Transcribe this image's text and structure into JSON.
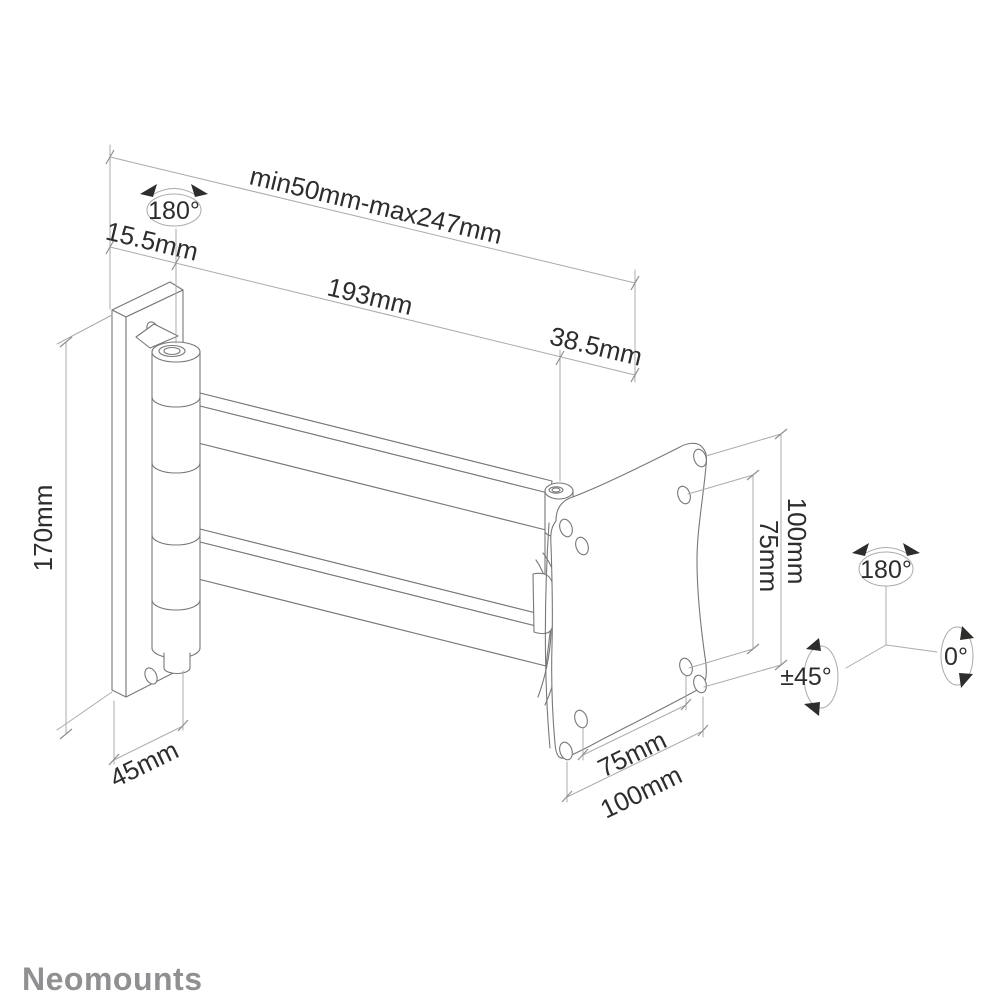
{
  "brand": {
    "logo_text": "Neomounts"
  },
  "dimensions": {
    "extension_range": "min50mm-max247mm",
    "wall_plate_offset": "15.5mm",
    "arm_length": "193mm",
    "head_offset": "38.5mm",
    "wall_plate_height": "170mm",
    "wall_plate_width": "45mm",
    "vesa_height_outer": "100mm",
    "vesa_height_inner": "75mm",
    "vesa_width_inner": "75mm",
    "vesa_width_outer": "100mm"
  },
  "angles": {
    "wall_swivel": "180°",
    "head_swivel": "180°",
    "tilt": "±45°",
    "screen_rotation": "0°"
  },
  "colors": {
    "background": "#ffffff",
    "structure_line": "#77787a",
    "dimension_line": "#ababab",
    "text": "#2e2d2c",
    "logo": "#8f9092"
  }
}
